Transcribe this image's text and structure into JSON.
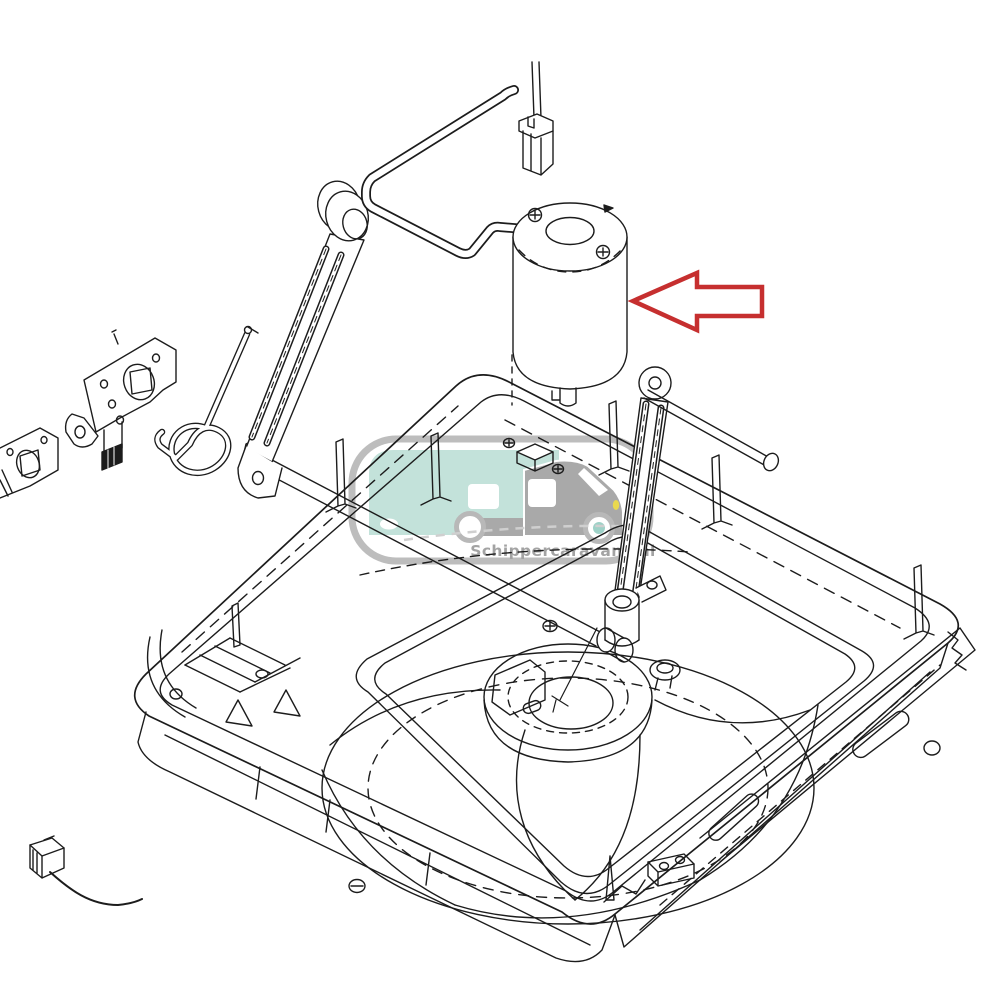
{
  "canvas": {
    "width": 1000,
    "height": 1000,
    "background": "#ffffff",
    "content": "exploded-parts line drawing of roof vent fan assembly"
  },
  "watermark": {
    "text": "Schippercaravans.nl",
    "border_color": "#bdbdbd",
    "text_color": "#a3a3a3",
    "body_color": "#c3e2da",
    "cab_color": "#a9a9a9",
    "window_color": "#ffffff",
    "wheel_ring_color": "#b8b8b8",
    "hub_color": "#9ed1c7",
    "headlight_color": "#e9d94f",
    "road_color": "#cfcfcf"
  },
  "annotation_arrow": {
    "direction": "left",
    "color": "#c62f2f",
    "fill": "#ffffff"
  },
  "colors": {
    "line": "#1c1c1c",
    "dark_fill": "#1c1c1c"
  }
}
